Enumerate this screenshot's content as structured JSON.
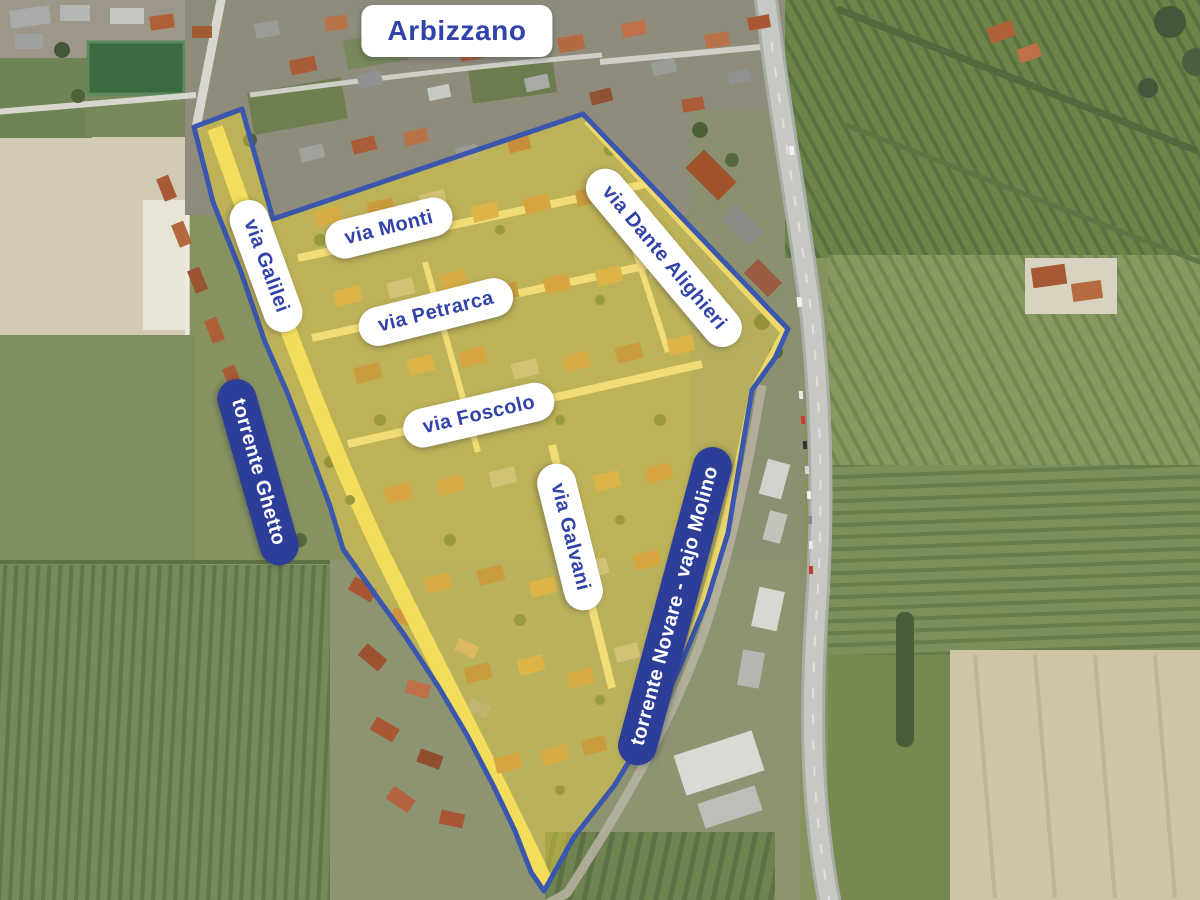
{
  "title": "Arbizzano",
  "streets": {
    "galilei": "via Galilei",
    "monti": "via Monti",
    "petrarca": "via Petrarca",
    "dante": "via Dante Alighieri",
    "foscolo": "via Foscolo",
    "galvani": "via Galvani"
  },
  "waterways": {
    "ghetto": "torrente Ghetto",
    "novare": "torrente Novare - vajo Molino"
  },
  "colors": {
    "label_text_blue": "#3143a8",
    "waterway_pill_navy": "#2d3e99",
    "boundary_stroke_blue": "#3a56ad",
    "zone_highlight_yellow": "#f6d93f"
  }
}
